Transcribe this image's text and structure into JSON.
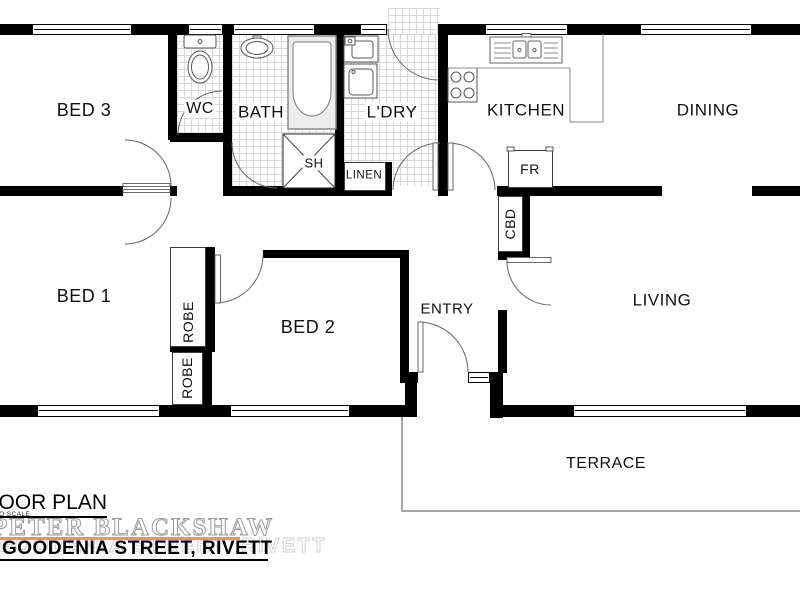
{
  "plan": {
    "rooms": {
      "bed3": {
        "label": "BED 3"
      },
      "wc": {
        "label": "WC"
      },
      "bath": {
        "label": "BATH"
      },
      "laundry": {
        "label": "L'DRY"
      },
      "kitchen": {
        "label": "KITCHEN"
      },
      "dining": {
        "label": "DINING"
      },
      "bed1": {
        "label": "BED 1"
      },
      "bed2": {
        "label": "BED 2"
      },
      "entry": {
        "label": "ENTRY"
      },
      "living": {
        "label": "LIVING"
      },
      "terrace": {
        "label": "TERRACE"
      }
    },
    "features": {
      "shower": {
        "label": "SH"
      },
      "linen": {
        "label": "LINEN"
      },
      "fridge": {
        "label": "FR"
      },
      "cupboard": {
        "label": "CBD"
      },
      "robe1": {
        "label": "ROBE"
      },
      "robe2": {
        "label": "ROBE"
      }
    },
    "fixture_icons": [
      "toilet-icon",
      "basin-icon",
      "bathtub-icon",
      "shower-screen-icon",
      "laundry-tub-icon",
      "washing-machine-icon",
      "double-sink-icon",
      "cooktop-icon",
      "window-symbol",
      "door-swing-arc"
    ],
    "wall_color": "#000000"
  },
  "footer": {
    "title": "FLOOR PLAN",
    "scale_note": "NOT TO SCALE",
    "brand": "PETER BLACKSHAW",
    "address": "GOODENIA STREET, RIVETT",
    "accent_color": "#D9A24A"
  }
}
